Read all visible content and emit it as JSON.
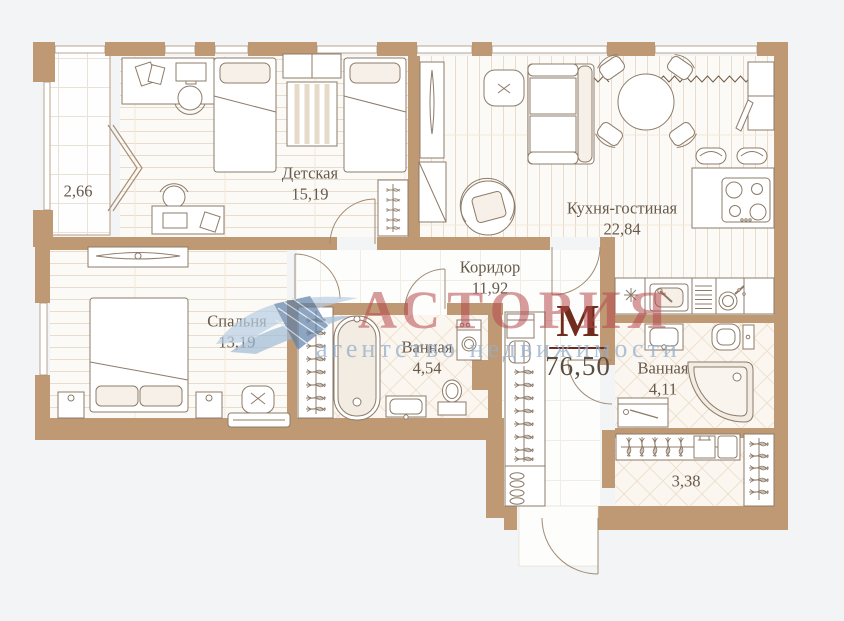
{
  "watermark": {
    "brand": "АСТОРИЯ",
    "tagline": "агентство недвижимости"
  },
  "total": {
    "marker": "М",
    "area": "76,50"
  },
  "rooms": [
    {
      "id": "kids",
      "label": "Детская",
      "area": "15,19"
    },
    {
      "id": "living",
      "label": "Кухня-гостиная",
      "area": "22,84"
    },
    {
      "id": "bedroom",
      "label": "Спальня",
      "area": "13,19"
    },
    {
      "id": "corridor",
      "label": "Коридор",
      "area": "11,92"
    },
    {
      "id": "bath-1",
      "label": "Ванная",
      "area": "4,54"
    },
    {
      "id": "bath-2",
      "label": "Ванная",
      "area": "4,11"
    },
    {
      "id": "balcony",
      "label": "",
      "area": "2,66"
    },
    {
      "id": "wardrobe",
      "label": "",
      "area": "3,38"
    }
  ],
  "colors": {
    "background": "#f3f4f6",
    "wall": "#bf9874",
    "furniture_line": "#8d7b69",
    "label_text": "#675a4c",
    "marker_red": "#6f2b1e",
    "watermark_red": "#b74a4d",
    "watermark_blue": "#93afcb"
  }
}
